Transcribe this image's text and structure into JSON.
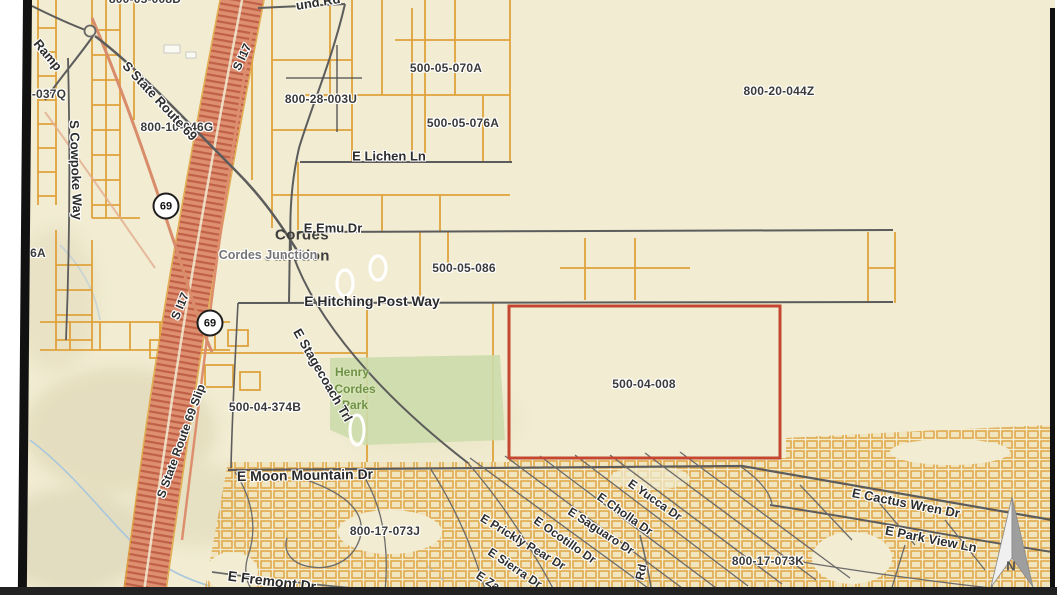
{
  "map": {
    "colors": {
      "background": "#f1ecd2",
      "parcel_line": "#dfa23c",
      "road": "#5c5c5c",
      "freeway": "#dd8f70",
      "freeway_stripe": "#c06046",
      "highlight_outline": "#c54732",
      "park_fill": "#ccdcab",
      "park_text": "#6f9246",
      "water": "#a9c7dc",
      "label": "#3a3a3a",
      "label_gray": "#767676"
    },
    "place": {
      "city_line1": "Cordes",
      "city_line2": "Junction",
      "junction_label": "Cordes Junction"
    },
    "park_label": {
      "line1": "Henry",
      "line2": "Cordes",
      "line3": "Park"
    },
    "highlight_parcel": {
      "apn": "500-04-008"
    },
    "shields": [
      {
        "route": "69"
      },
      {
        "route": "69"
      }
    ],
    "north_arrow": {
      "label": "N"
    },
    "parcel_labels": [
      {
        "text": "800-05-008D"
      },
      {
        "text": "-037Q"
      },
      {
        "text": "800-10-046G"
      },
      {
        "text": "800-28-003U"
      },
      {
        "text": "500-05-070A"
      },
      {
        "text": "500-05-076A"
      },
      {
        "text": "800-20-044Z"
      },
      {
        "text": "500-05-086"
      },
      {
        "text": "500-04-374B"
      },
      {
        "text": "500-04-008"
      },
      {
        "text": "800-17-073J"
      },
      {
        "text": "800-17-073K"
      },
      {
        "text": "6A"
      }
    ],
    "street_labels": [
      {
        "text": "S State Route 69"
      },
      {
        "text": "Ramp"
      },
      {
        "text": "S Cowpoke Way"
      },
      {
        "text": "S I17"
      },
      {
        "text": "S I17"
      },
      {
        "text": "S State Route 69 Slip"
      },
      {
        "text": "und Rd"
      },
      {
        "text": "E Lichen Ln"
      },
      {
        "text": "E Emu Dr"
      },
      {
        "text": "E Hitching Post Way"
      },
      {
        "text": "E Stagecoach Trl"
      },
      {
        "text": "E Moon Mountain Dr"
      },
      {
        "text": "E Yucca Dr"
      },
      {
        "text": "E Cholla Dr"
      },
      {
        "text": "E Saguaro Dr"
      },
      {
        "text": "E Ocotillo Dr"
      },
      {
        "text": "E Prickly Pear Dr"
      },
      {
        "text": "E Sierra Dr"
      },
      {
        "text": "E Za"
      },
      {
        "text": "Rd"
      },
      {
        "text": "E Fremont Dr"
      },
      {
        "text": "E Cactus Wren Dr"
      },
      {
        "text": "E Park View Ln"
      }
    ]
  }
}
